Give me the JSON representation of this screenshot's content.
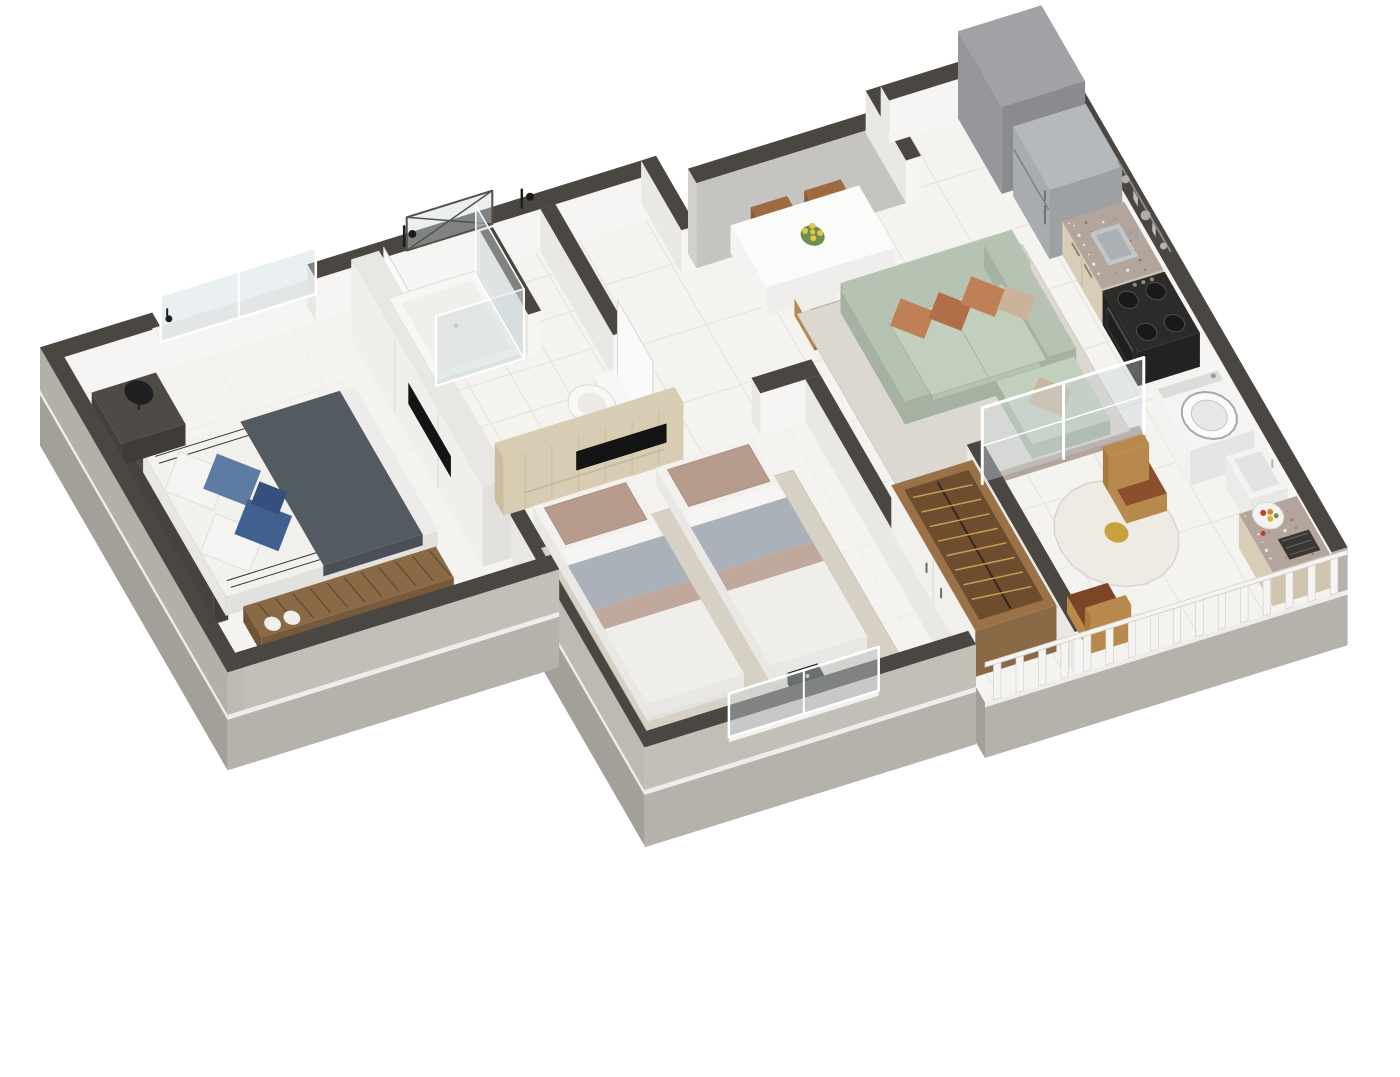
{
  "scene": {
    "title": "3D isometric cutaway floor plan of a compact two-bedroom apartment",
    "background": "#ffffff",
    "view_style": "axonometric-cutaway"
  },
  "palette": {
    "wallTop": "#4a4641",
    "wallFace": "#f6f5f3",
    "wallFaceShade": "#eae8e4",
    "extWall": "#b5b1ab",
    "extWallDark": "#a39f99",
    "extWallLight": "#c2beb8",
    "slabEdge": "#efede9",
    "floor": "#f4f3f0",
    "tileLine": "#e4e2dd",
    "tileLineFaint": "#edece8",
    "rugBedroom": "#d7d0c5",
    "rugLiving": "#dcd8d0",
    "woodPanel": "#d8ccb2",
    "woodPanelGrain": "#cabc9e",
    "woodDark": "#8a6a46",
    "woodMid": "#9b7148",
    "woodSlat": "#5f4730",
    "wardrobeInterior": "#6e4c2e",
    "hangerWood": "#c89a5e",
    "bedLinen": "#f2f1ee",
    "bedLinenShade": "#e3e1dd",
    "charcoalThrow": "#545a61",
    "pillowBlue": "#5d7ba3",
    "pillowBlueDark": "#41608f",
    "pillowNavy": "#35507c",
    "tanPillow": "#b79b8c",
    "grayBlanket": "#aab1b8",
    "sofaSage": "#b6c2b2",
    "sofaSageDark": "#a5b2a1",
    "sofaSageLight": "#c3cfbd",
    "terracotta": "#c08057",
    "terracottaDark": "#b06f48",
    "beigePillow": "#cbb39b",
    "steel": "#a9acae",
    "steelDark": "#9ea1a3",
    "steelTop": "#b6b9bb",
    "stoveBlack": "#2c2b2a",
    "ovenBlack": "#1f1f1f",
    "applianceWhite": "#f2f2f1",
    "applianceShade": "#e6e5e3",
    "granite": "#b3a59c",
    "graniteDot1": "#8d7f76",
    "graniteDot2": "#eee8e2",
    "cabinetBeige": "#d8cdb6",
    "cabinetBeigeDark": "#cfc4ad",
    "marble": "#eeebe5",
    "chairWood": "#b8894c",
    "chairWoodDark": "#9c6b3f",
    "leather": "#8a4f2c",
    "leatherDark": "#7c4526",
    "glass": "rgba(205,216,221,0.42)",
    "glassDark": "rgba(198,210,215,0.35)",
    "frameWhite": "#ffffff",
    "frameDark": "#55504a",
    "grayBoxTop": "#a2a1a5",
    "grayBox": "#969599",
    "grayBoxDark": "#8b8a8e",
    "recessWallFace": "#c6c4c1",
    "doorWhite": "#fbfafa",
    "doorEdge": "#d9d6d1",
    "flowerYellow": "#e7c445",
    "leafGreen": "#6a8f4f",
    "railWhite": "#f5f4f2",
    "railStroke": "#cfccc6",
    "lampBlack": "#1f1f1f",
    "bathFixture": "#1c1c1c",
    "inox": "#c3c6c8",
    "inoxDark": "#aab0b3",
    "tvBlack": "#141414",
    "fruitRed": "#c23b2e",
    "fruitOrange": "#d9842b",
    "fruitYellow": "#e0b42c",
    "bowlGold": "#c8a23f"
  },
  "rooms": [
    {
      "id": "master-bedroom",
      "label": "Master bedroom",
      "items": [
        "double-bed",
        "white-pillows",
        "blue-pillows",
        "charcoal-throw",
        "headboard",
        "slat-bench",
        "nightstand",
        "table-lamp",
        "wall-sconce",
        "built-in-wardrobe",
        "wall-tv",
        "window"
      ]
    },
    {
      "id": "bathroom",
      "label": "Bathroom",
      "items": [
        "shower-tray",
        "shower-glass",
        "half-wall",
        "toilet",
        "shower-fixtures",
        "transom-window",
        "door"
      ]
    },
    {
      "id": "dining-nook",
      "label": "Hall dining nook",
      "items": [
        "white-dining-table",
        "four-wood-chairs",
        "yellow-flower-vase",
        "entry-wall"
      ]
    },
    {
      "id": "second-bedroom",
      "label": "Second bedroom",
      "items": [
        "single-bed-left",
        "single-bed-right",
        "tan-pillows",
        "gray-blankets",
        "area-rug",
        "media-device",
        "window"
      ]
    },
    {
      "id": "living-room",
      "label": "Living room",
      "items": [
        "sage-sofa",
        "chaise",
        "terracotta-pillows",
        "beige-pillows",
        "area-rug",
        "tv-panel-wall",
        "wall-tv"
      ]
    },
    {
      "id": "kitchen",
      "label": "Kitchen",
      "items": [
        "refrigerator",
        "gray-column",
        "granite-countertop",
        "inox-sink",
        "faucet",
        "utensil-rack",
        "gas-stove",
        "oven"
      ]
    },
    {
      "id": "service-area",
      "label": "Service area",
      "items": [
        "washing-machine",
        "laundry-tub",
        "glass-partition"
      ]
    },
    {
      "id": "balcony",
      "label": "Balcony",
      "items": [
        "round-marble-table",
        "gold-bowl",
        "leather-wood-chairs",
        "granite-cabinet",
        "built-in-grill",
        "fruit-bowl",
        "white-railing",
        "sliding-glass-door"
      ]
    },
    {
      "id": "wardrobe-nook",
      "label": "Wardrobe nook",
      "items": [
        "open-wardrobe",
        "clothes-hangers",
        "white-doors"
      ]
    }
  ]
}
